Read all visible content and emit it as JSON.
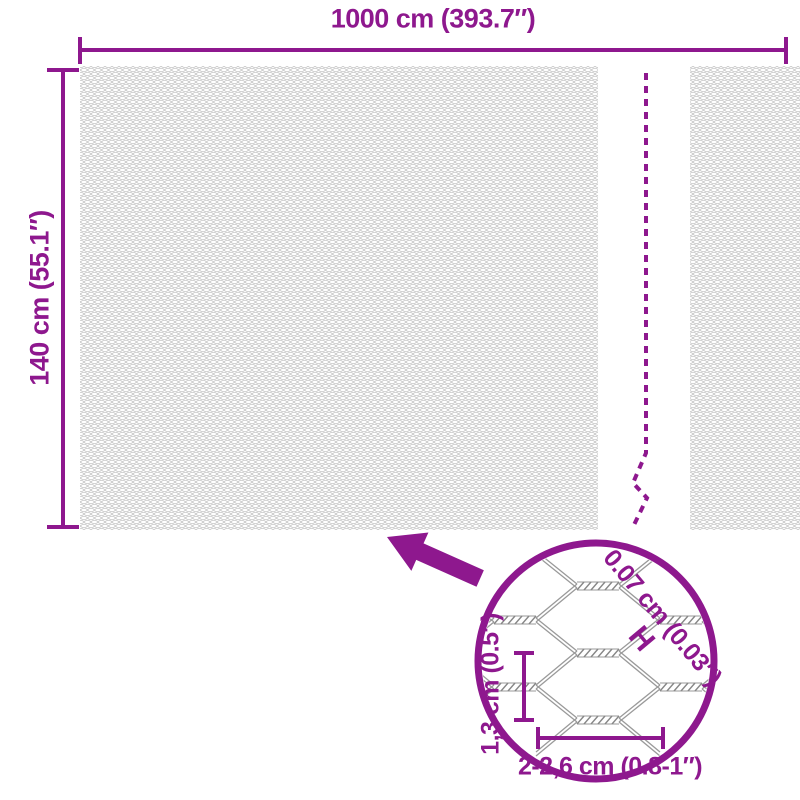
{
  "labels": {
    "width": "1000 cm (393.7″)",
    "height": "140 cm (55.1″)",
    "wire_thickness": "0.07 cm (0.03″)",
    "wire_thickness_marker": "H",
    "mesh_cell_height": "1,3 cm (0.5″)",
    "mesh_cell_width": "2-2,6 cm (0.8-1″)"
  },
  "icons": {
    "arrow": "zoom-callout-arrow",
    "circle": "detail-magnifier-circle"
  },
  "colors": {
    "accent": "#8E188E",
    "mesh_texture": "#c6c6c6",
    "wire": "#9a9a9a",
    "twist": "#878787"
  }
}
